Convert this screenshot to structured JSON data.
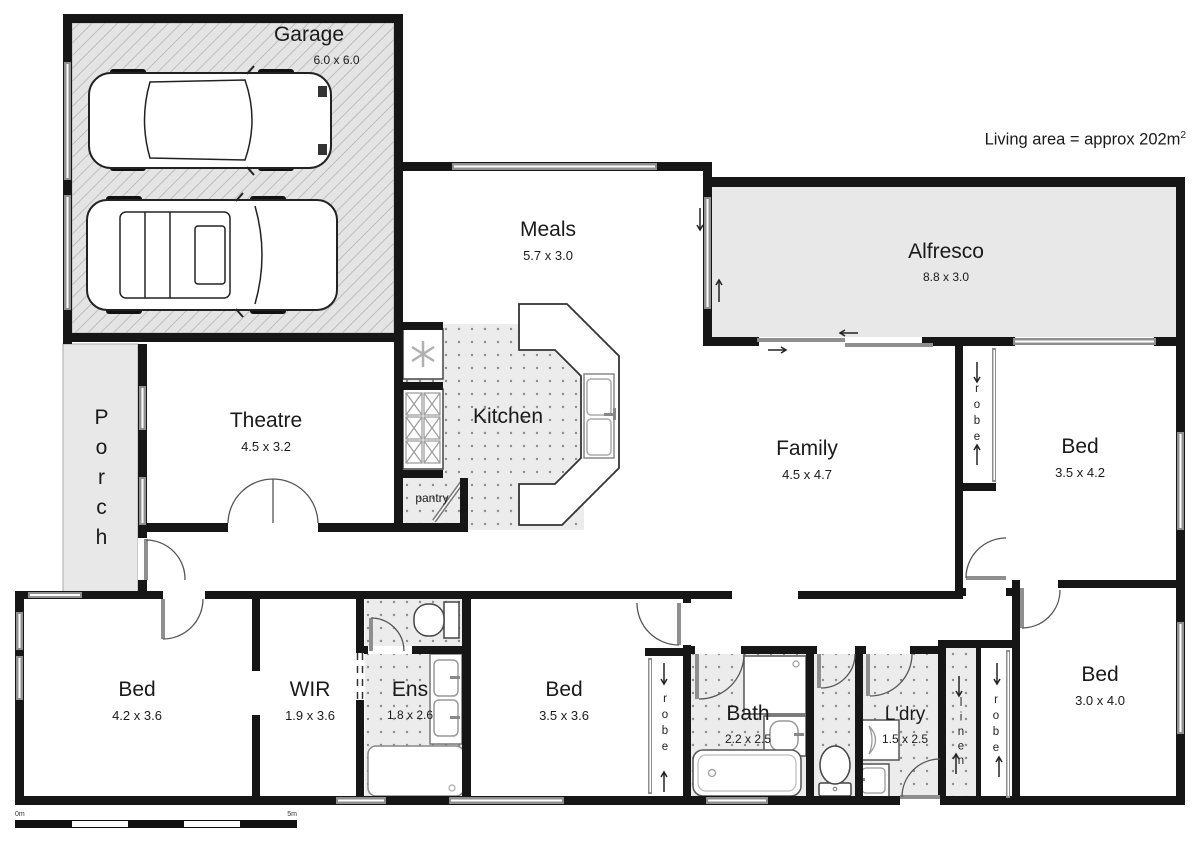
{
  "annotation": {
    "living_area": "Living area = approx 202m",
    "living_area_sup": "2"
  },
  "rooms": {
    "garage": {
      "label": "Garage",
      "dims": "6.0 x 6.0"
    },
    "porch": {
      "label": "Porch"
    },
    "theatre": {
      "label": "Theatre",
      "dims": "4.5 x 3.2"
    },
    "meals": {
      "label": "Meals",
      "dims": "5.7 x 3.0"
    },
    "kitchen": {
      "label": "Kitchen"
    },
    "pantry": {
      "label": "pantry"
    },
    "alfresco": {
      "label": "Alfresco",
      "dims": "8.8 x 3.0"
    },
    "family": {
      "label": "Family",
      "dims": "4.5 x 4.7"
    },
    "bed_top_right": {
      "label": "Bed",
      "dims": "3.5 x 4.2"
    },
    "bed_bottom_left": {
      "label": "Bed",
      "dims": "4.2 x 3.6"
    },
    "wir": {
      "label": "WIR",
      "dims": "1.9 x 3.6"
    },
    "ens": {
      "label": "Ens",
      "dims": "1.8 x 2.6"
    },
    "bed_bottom_mid": {
      "label": "Bed",
      "dims": "3.5 x 3.6"
    },
    "bath": {
      "label": "Bath",
      "dims": "2.2 x 2.5"
    },
    "ldry": {
      "label": "L'dry",
      "dims": "1.5 x 2.5"
    },
    "bed_bottom_right": {
      "label": "Bed",
      "dims": "3.0 x 4.0"
    }
  },
  "storage": {
    "robe_family": "robe",
    "robe_mid": "robe",
    "robe_right": "robe",
    "linen": "linen"
  },
  "scale_bar": {
    "start_label": "0m",
    "end_label": "5m"
  },
  "colors": {
    "wall": "#161616",
    "outdoor_fill": "#e8e8e8",
    "tile_fill": "#ededed",
    "window": "#8f8f8f"
  }
}
